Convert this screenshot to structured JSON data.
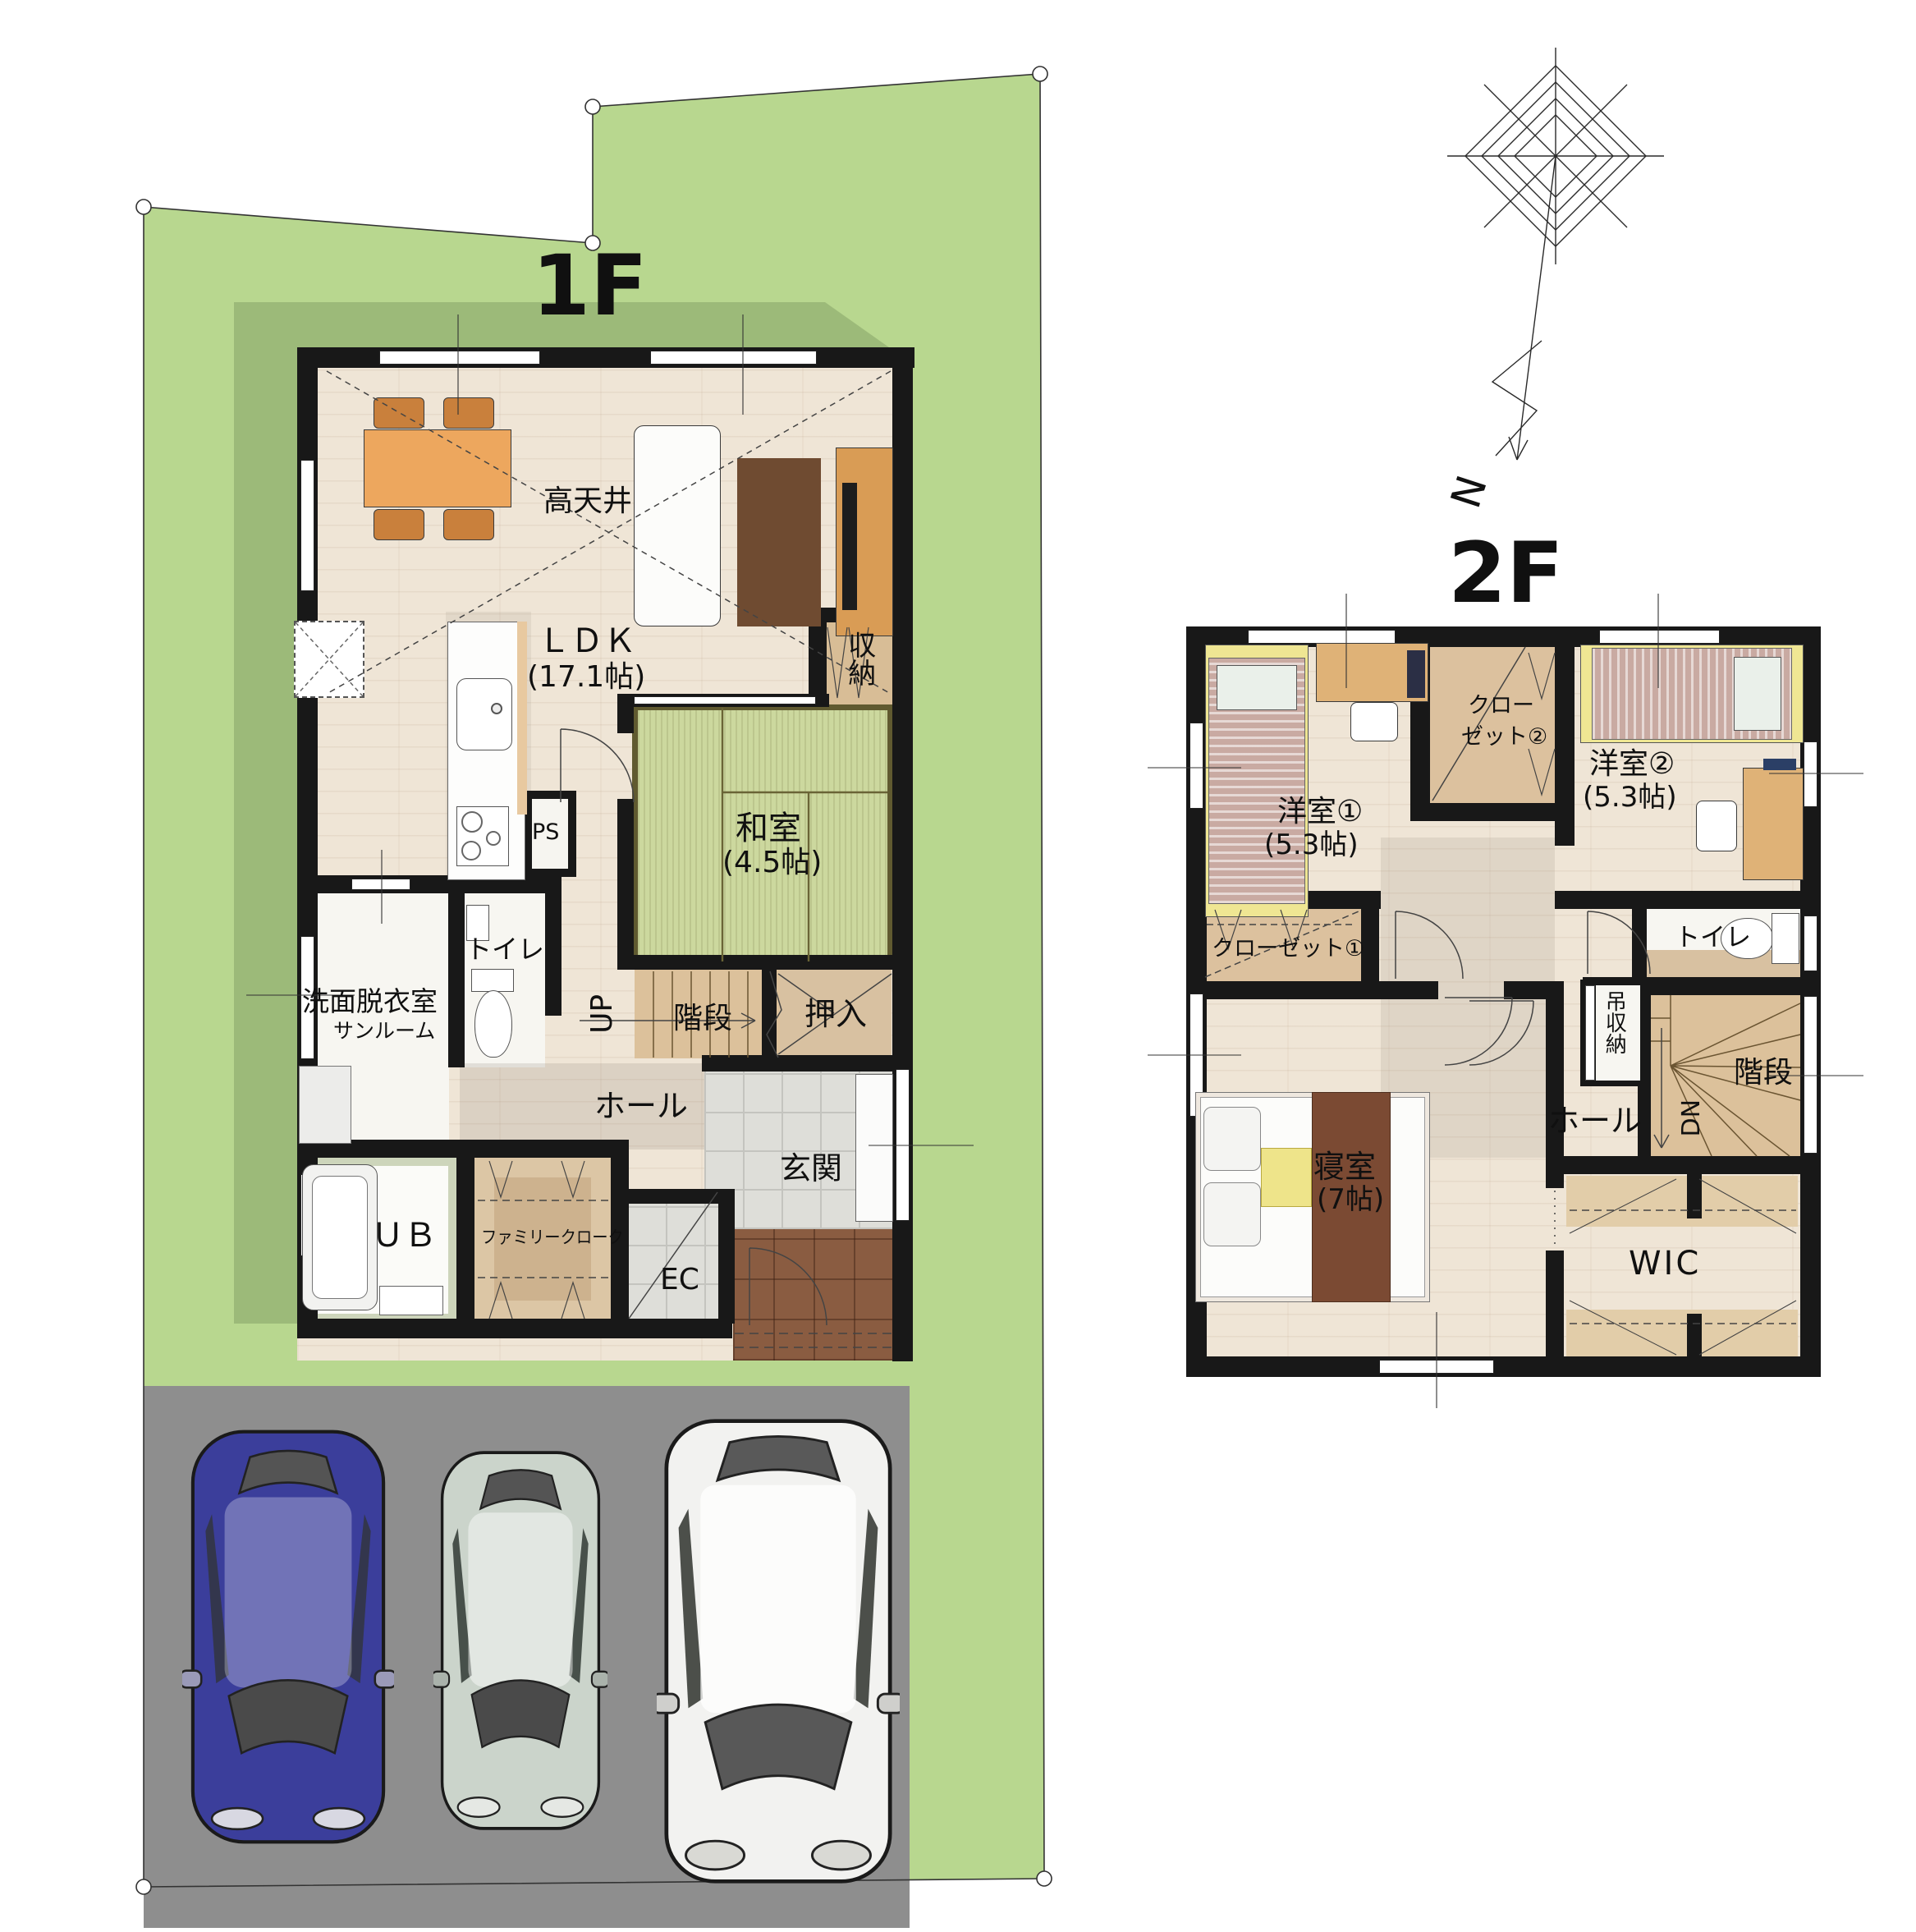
{
  "floor1": {
    "title": "1F",
    "rooms": {
      "high_ceiling": "高天井",
      "ldk": "ＬＤＫ",
      "ldk_size": "(17.1帖)",
      "washitsu": "和室",
      "washitsu_size": "(4.5帖)",
      "shunou": "収納",
      "toilet": "トイレ",
      "senmen": "洗面脱衣室",
      "sunroom": "サンルーム",
      "up": "UP",
      "stairs": "階段",
      "oshiire": "押入",
      "hall": "ホール",
      "genkan": "玄関",
      "ub": "ＵＢ",
      "family_cloak": "ファミリークローク",
      "ec": "EC",
      "ps": "PS"
    }
  },
  "floor2": {
    "title": "2F",
    "rooms": {
      "yoshitsu1": "洋室①",
      "yoshitsu1_size": "(5.3帖)",
      "closet2_line1": "クロー",
      "closet2_line2": "ゼット②",
      "yoshitsu2": "洋室②",
      "yoshitsu2_size": "(5.3帖)",
      "closet1": "クローゼット①",
      "toilet": "トイレ",
      "tsurishuno": "吊収納",
      "stairs": "階段",
      "dn": "DN",
      "hall": "ホール",
      "bedroom": "寝室",
      "bedroom_size": "(7帖)",
      "wic": "WIC"
    }
  },
  "compass": {
    "north": "N"
  },
  "colors": {
    "grass": "#b8d78f",
    "grasssh": "#9cba79",
    "parking": "#8e8e8e",
    "wall": "#181818",
    "wood": "#efe5d6",
    "wooddark": "#dcc19b",
    "tatami": "#ccd89e",
    "tatamiedge": "#605a30",
    "tile": "#deded9",
    "porch": "#8a5c41",
    "text": "#101010",
    "car1": "#3b3e9b",
    "car2": "#cbd4cb",
    "car3": "#f2f2f0",
    "table": "#eda75e",
    "deskwood": "#dfb277",
    "quilt": "#7b4a33",
    "bedstripe": "#c9aaa2",
    "bedyellow": "#efe693",
    "rug": "#6f4b31"
  }
}
